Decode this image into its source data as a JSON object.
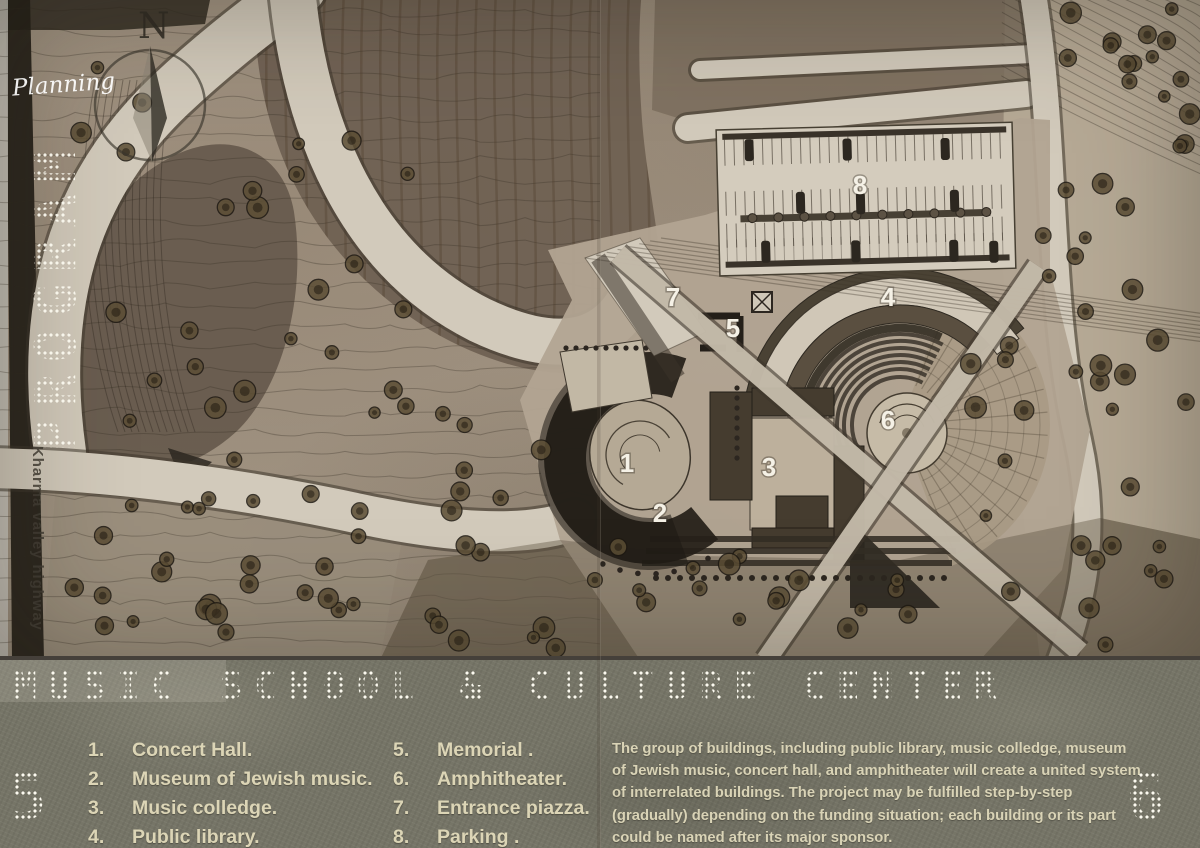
{
  "board": {
    "handwritten_label": "Planning",
    "vertical_watermark": "PROGRAM",
    "highway_label": "Kharma valley highway",
    "compass_north": "N",
    "left_sheet_number": "5",
    "right_sheet_number": "6"
  },
  "title_bar": {
    "title": "MUSIC SCHOOL & CULTURE CENTER"
  },
  "legend": {
    "column1": [
      {
        "num": "1.",
        "label": "Concert Hall."
      },
      {
        "num": "2.",
        "label": "Museum of Jewish music."
      },
      {
        "num": "3.",
        "label": "Music colledge."
      },
      {
        "num": "4.",
        "label": "Public library."
      }
    ],
    "column2": [
      {
        "num": "5.",
        "label": "Memorial ."
      },
      {
        "num": "6.",
        "label": "Amphitheater."
      },
      {
        "num": "7.",
        "label": "Entrance piazza."
      },
      {
        "num": "8.",
        "label": "Parking ."
      }
    ]
  },
  "description": "The group of buildings, including public library, music colledge, museum of Jewish  music, concert hall, and amphitheater will create a united system of interrelated  buildings. The project may be fulfilled step-by-step (gradually) depending on the  funding situation; each building or its part could be named after its major sponsor.",
  "map_labels": [
    {
      "num": "1",
      "x": 627,
      "y": 472
    },
    {
      "num": "2",
      "x": 660,
      "y": 522
    },
    {
      "num": "3",
      "x": 769,
      "y": 476
    },
    {
      "num": "4",
      "x": 888,
      "y": 306
    },
    {
      "num": "5",
      "x": 733,
      "y": 337
    },
    {
      "num": "6",
      "x": 888,
      "y": 429
    },
    {
      "num": "7",
      "x": 673,
      "y": 306
    },
    {
      "num": "8",
      "x": 860,
      "y": 194
    }
  ],
  "colors": {
    "map_base": "#a29584",
    "terrain_dark": "#6b5d4e",
    "road_light": "#d2cabb",
    "roof_dark": "#453c2f",
    "crescent_shadow": "#262119",
    "title_bar": "#767567",
    "legend_text": "#dcd5b6",
    "dot_matrix_text": "#f4f1e7"
  }
}
